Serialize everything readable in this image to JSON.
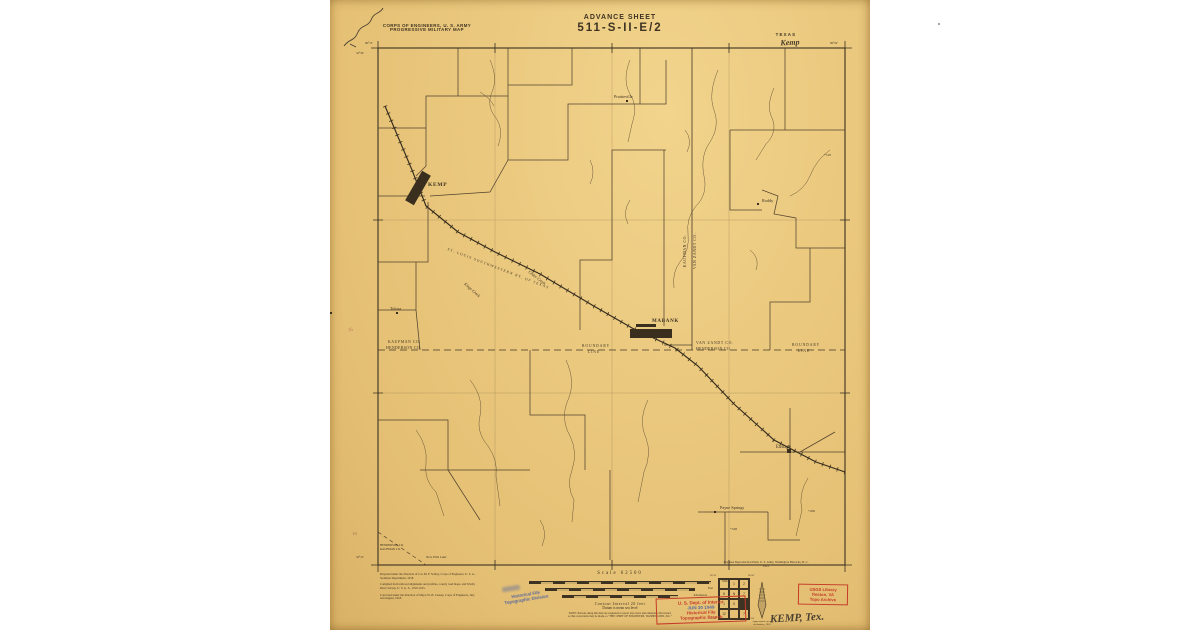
{
  "header": {
    "agency_line1": "CORPS OF ENGINEERS, U. S. ARMY",
    "agency_line2": "PROGRESSIVE MILITARY MAP",
    "advance_sheet": "ADVANCE SHEET",
    "sheet_number": "511-S-II-E/2",
    "state": "TEXAS",
    "quad_name": "Kemp"
  },
  "map": {
    "towns": {
      "kemp": "KEMP",
      "mabank": "MABANK",
      "tolosa": "Tolosa",
      "prairieville": "Prairieville",
      "roddy": "Roddy",
      "eustace": "Eustace",
      "payne_springs": "Payne Springs"
    },
    "boundaries": {
      "left_upper": "KAUFMAN CO.",
      "left_lower": "HENDERSON CO.",
      "left_line1": "BOUNDARY",
      "left_line2": "LINE",
      "center_upper": "VAN ZANDT CO.",
      "center_lower": "HENDERSON CO.",
      "right_line1": "BOUNDARY",
      "right_line2": "LINE",
      "vertical_west": "KAUFMAN CO.",
      "vertical_east": "VAN ZANDT CO."
    },
    "railroad_label": "ST. LOUIS SOUTHWESTERN RY. OF TEXAS",
    "creeks": {
      "kings": "Kings Creek",
      "cedar": "Cedar Creek"
    },
    "elevations": {
      "e1": "+518",
      "e2": "+436",
      "e3": "+528"
    },
    "corner_block": {
      "line1": "HENDERSON CO.",
      "line2": "KAUFMAN CO.",
      "line3": "New Ellis Lake"
    },
    "graticule": {
      "top_left": "96°15'",
      "top_right": "96°00'",
      "left_top": "32°30'",
      "left_bottom": "32°15'"
    },
    "margin_mark": "16"
  },
  "footer": {
    "credits_left": {
      "p1": "Prepared under the direction of Col. M. F. Schley, Corps of Engineers, U. S. A., Southern Department, 1918.",
      "p2": "Compiled from railroad alignments and profiles, county road maps, and Trinity River Survey, U. S. G. S., 1910-1915.",
      "p3": "Corrected under the direction of Major W. B. Causey, Corps of Engineers, July and August, 1918."
    },
    "scale_title": "Scale 62500",
    "bar_units": {
      "miles": "Miles",
      "feet": "Feet",
      "kilometers": "Kilometers"
    },
    "contour": "Contour Interval 20 feet",
    "datum": "Datum is mean sea level",
    "note_line1": "NOTE: Persons using this map are requested to report any errors and omissions discovered,",
    "note_line2": "so that corrections may be made, to \"THE CHIEF OF ENGINEERS, WASHINGTON, D.C.\"",
    "credit_right_line1": "Engineer Reproduction Plant, U. S. Army, Washington Barracks, D. C.",
    "credit_right_line2": "1921",
    "index": {
      "cells": [
        "",
        "1",
        "2",
        "8",
        "N",
        "7",
        "1",
        "5",
        "",
        "12",
        "",
        "7"
      ],
      "tl": "96°30'",
      "tr": "96°00'",
      "bl": "32°30'",
      "br": "32°00'"
    },
    "declination_line1": "Approximate mean",
    "declination_line2": "declination, 1918"
  },
  "stamps": {
    "interior": {
      "line1": "U. S. Dept. of Interior",
      "line2": "JUN 30 1949",
      "line3": "Historical File",
      "line4": "Topographic Branch"
    },
    "usgs": {
      "line1": "USGS Library",
      "line2": "Reston, VA",
      "line3": "Topo Archive"
    },
    "blue": {
      "line1": "Historical File",
      "line2": "Topographic Division"
    },
    "handwritten": "KEMP, Tex."
  }
}
